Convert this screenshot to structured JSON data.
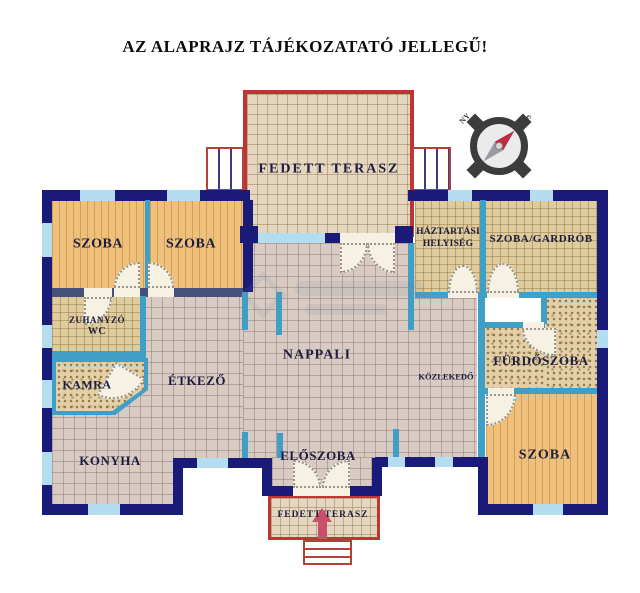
{
  "title": "AZ ALAPRAJZ TÁJÉKOZATATÓ JELLEGŰ!",
  "rooms": {
    "terrace_top": "FEDETT TERASZ",
    "szoba_left_1": "SZOBA",
    "szoba_left_2": "SZOBA",
    "haztartasi_line1": "HÁZTARTÁSI",
    "haztartasi_line2": "HELYISÉG",
    "szoba_gardrob": "SZOBA/GARDRÓB",
    "zuhanyzo": "ZUHANYZÓ",
    "wc": "WC",
    "nappali": "NAPPALI",
    "kamra": "KAMRA",
    "etkezo": "ÉTKEZŐ",
    "kozlekedo": "KÖZLEKEDŐ",
    "furdoszoba": "FÜRDŐSZOBA",
    "konyha": "KONYHA",
    "eloszoba": "ELŐSZOBA",
    "szoba_bottom_right": "SZOBA",
    "terrace_bottom": "FEDETT TERASZ"
  },
  "compass": {
    "north": "É",
    "south": "D",
    "east": "K",
    "west": "NY"
  },
  "colors": {
    "wall_navy": "#1a1a78",
    "wall_teal": "#3f9fc6",
    "window_blue": "#b4ddef",
    "terrace_red": "#c13434",
    "wood_floor": "#eec07c",
    "tile_floor": "#d8cbc3"
  }
}
